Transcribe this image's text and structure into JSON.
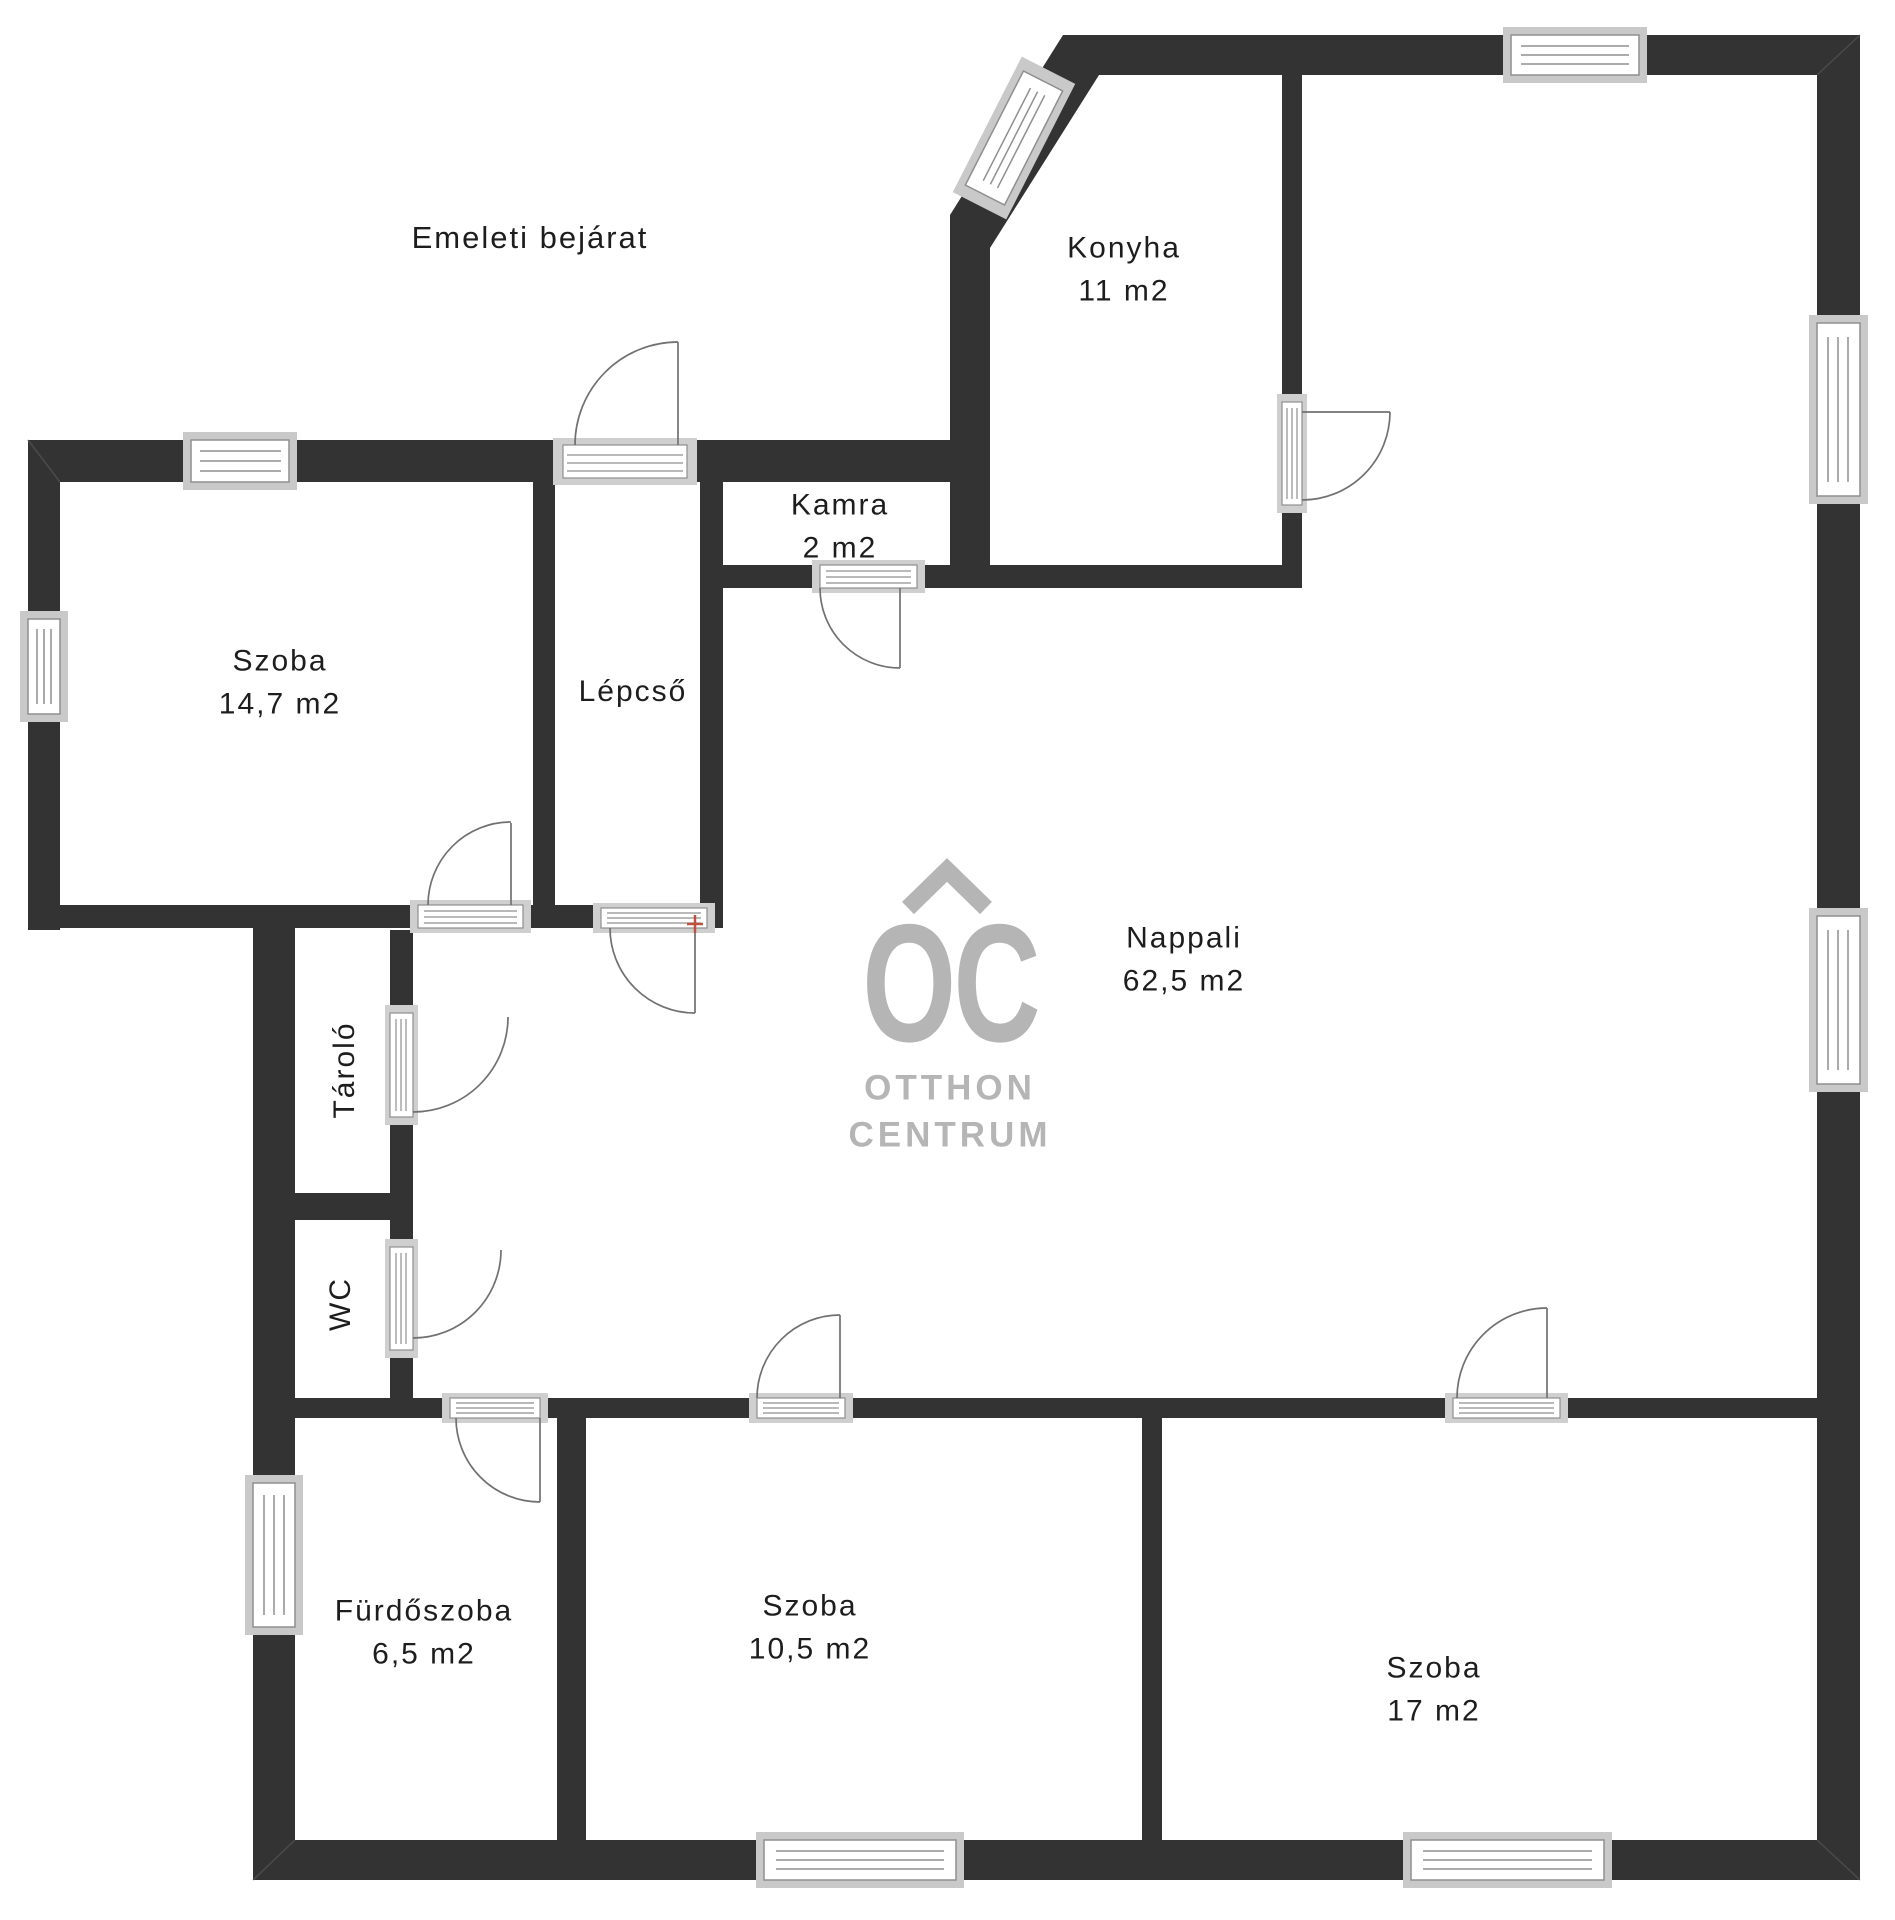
{
  "plan": {
    "annotation": "Emeleti bejárat",
    "watermark": {
      "monogram": "OC",
      "line1": "OTTHON",
      "line2": "CENTRUM"
    },
    "rooms": [
      {
        "id": "szoba-left",
        "name": "Szoba",
        "area": "14,7 m2"
      },
      {
        "id": "lepcso",
        "name": "Lépcső",
        "area": ""
      },
      {
        "id": "kamra",
        "name": "Kamra",
        "area": "2 m2"
      },
      {
        "id": "konyha",
        "name": "Konyha",
        "area": "11 m2"
      },
      {
        "id": "nappali",
        "name": "Nappali",
        "area": "62,5 m2"
      },
      {
        "id": "tarolo",
        "name": "Tároló",
        "area": ""
      },
      {
        "id": "wc",
        "name": "WC",
        "area": ""
      },
      {
        "id": "furdoszoba",
        "name": "Fürdőszoba",
        "area": "6,5 m2"
      },
      {
        "id": "szoba-middle",
        "name": "Szoba",
        "area": "10,5 m2"
      },
      {
        "id": "szoba-right",
        "name": "Szoba",
        "area": "17 m2"
      }
    ],
    "colors": {
      "wall": "#333333",
      "sill": "#c9c9c9",
      "door_line": "#717171",
      "frame_line": "#8f8f8f",
      "watermark": "#b5b5b5",
      "marker": "#c0503f",
      "text": "#1d1d1d"
    }
  }
}
